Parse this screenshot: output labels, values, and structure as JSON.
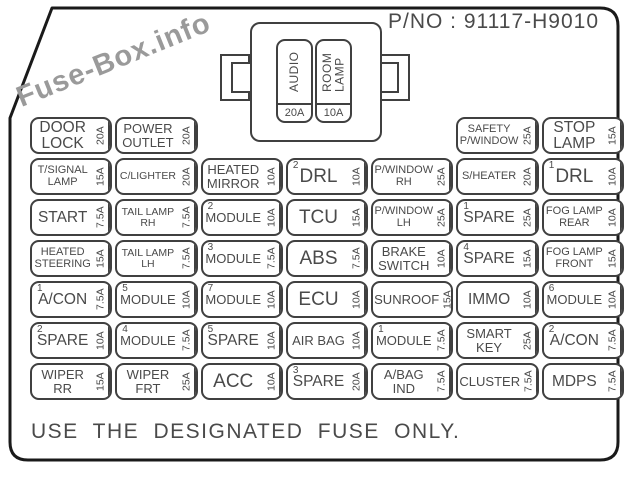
{
  "watermark": "Fuse-Box.info",
  "part_no": "P/NO : 91117-H9010",
  "footer": "USE THE DESIGNATED FUSE ONLY.",
  "colors": {
    "line": "#404040",
    "outline": "#1a1a1a",
    "text": "#4a4a4a",
    "watermark": "#9a9a9a"
  },
  "relay_block": {
    "fuses": [
      {
        "label": "AUDIO",
        "amp": "20A"
      },
      {
        "label": "ROOM\nLAMP",
        "amp": "10A"
      }
    ]
  },
  "fuse_rows": [
    [
      {
        "col": 1,
        "label": "DOOR\nLOCK",
        "amp": "20A"
      },
      {
        "col": 2,
        "label": "POWER\nOUTLET",
        "amp": "20A"
      },
      {
        "col": 6,
        "label": "SAFETY\nP/WINDOW",
        "amp": "25A"
      },
      {
        "col": 7,
        "label": "STOP\nLAMP",
        "amp": "15A"
      }
    ],
    [
      {
        "col": 1,
        "label": "T/SIGNAL\nLAMP",
        "amp": "15A"
      },
      {
        "col": 2,
        "label": "C/LIGHTER",
        "amp": "20A"
      },
      {
        "col": 3,
        "label": "HEATED\nMIRROR",
        "amp": "10A"
      },
      {
        "col": 4,
        "num": "2",
        "label": "DRL",
        "amp": "10A"
      },
      {
        "col": 5,
        "label": "P/WINDOW\nRH",
        "amp": "25A"
      },
      {
        "col": 6,
        "label": "S/HEATER",
        "amp": "20A"
      },
      {
        "col": 7,
        "num": "1",
        "label": "DRL",
        "amp": "10A"
      }
    ],
    [
      {
        "col": 1,
        "label": "START",
        "amp": "7.5A"
      },
      {
        "col": 2,
        "label": "TAIL LAMP\nRH",
        "amp": "7.5A"
      },
      {
        "col": 3,
        "num": "2",
        "label": "MODULE",
        "amp": "10A"
      },
      {
        "col": 4,
        "label": "TCU",
        "amp": "15A"
      },
      {
        "col": 5,
        "label": "P/WINDOW\nLH",
        "amp": "25A"
      },
      {
        "col": 6,
        "num": "1",
        "label": "SPARE",
        "amp": "25A"
      },
      {
        "col": 7,
        "label": "FOG LAMP\nREAR",
        "amp": "10A"
      }
    ],
    [
      {
        "col": 1,
        "label": "HEATED\nSTEERING",
        "amp": "15A"
      },
      {
        "col": 2,
        "label": "TAIL LAMP\nLH",
        "amp": "7.5A"
      },
      {
        "col": 3,
        "num": "3",
        "label": "MODULE",
        "amp": "7.5A"
      },
      {
        "col": 4,
        "label": "ABS",
        "amp": "7.5A"
      },
      {
        "col": 5,
        "label": "BRAKE\nSWITCH",
        "amp": "10A"
      },
      {
        "col": 6,
        "num": "4",
        "label": "SPARE",
        "amp": "15A"
      },
      {
        "col": 7,
        "label": "FOG LAMP\nFRONT",
        "amp": "15A"
      }
    ],
    [
      {
        "col": 1,
        "num": "1",
        "label": "A/CON",
        "amp": "7.5A"
      },
      {
        "col": 2,
        "num": "5",
        "label": "MODULE",
        "amp": "10A"
      },
      {
        "col": 3,
        "num": "7",
        "label": "MODULE",
        "amp": "10A"
      },
      {
        "col": 4,
        "label": "ECU",
        "amp": "10A"
      },
      {
        "col": 5,
        "label": "SUNROOF",
        "amp": "15A"
      },
      {
        "col": 6,
        "label": "IMMO",
        "amp": "10A"
      },
      {
        "col": 7,
        "num": "6",
        "label": "MODULE",
        "amp": "10A"
      }
    ],
    [
      {
        "col": 1,
        "num": "2",
        "label": "SPARE",
        "amp": "10A"
      },
      {
        "col": 2,
        "num": "4",
        "label": "MODULE",
        "amp": "7.5A"
      },
      {
        "col": 3,
        "num": "5",
        "label": "SPARE",
        "amp": "10A"
      },
      {
        "col": 4,
        "label": "AIR BAG",
        "amp": "10A"
      },
      {
        "col": 5,
        "num": "1",
        "label": "MODULE",
        "amp": "7.5A"
      },
      {
        "col": 6,
        "label": "SMART\nKEY",
        "amp": "25A"
      },
      {
        "col": 7,
        "num": "2",
        "label": "A/CON",
        "amp": "7.5A"
      }
    ],
    [
      {
        "col": 1,
        "label": "WIPER\nRR",
        "amp": "15A"
      },
      {
        "col": 2,
        "label": "WIPER\nFRT",
        "amp": "25A"
      },
      {
        "col": 3,
        "label": "ACC",
        "amp": "10A"
      },
      {
        "col": 4,
        "num": "3",
        "label": "SPARE",
        "amp": "20A"
      },
      {
        "col": 5,
        "label": "A/BAG\nIND",
        "amp": "7.5A"
      },
      {
        "col": 6,
        "label": "CLUSTER",
        "amp": "7.5A"
      },
      {
        "col": 7,
        "label": "MDPS",
        "amp": "7.5A"
      }
    ]
  ]
}
